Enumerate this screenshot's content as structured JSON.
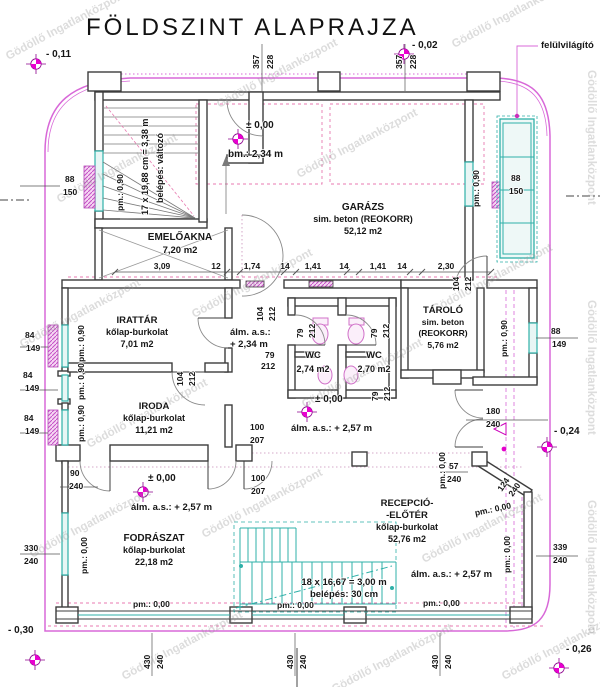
{
  "title": "FÖLDSZINT  ALAPRAJZA",
  "watermark": "Gödöllő Ingatlanközpont",
  "callouts": {
    "skylight": "felülvilágító"
  },
  "levels": {
    "minus011": "- 0,11",
    "minus002": "- 0,02",
    "zero": "± 0,00",
    "minus024": "- 0,24",
    "minus030": "- 0,30",
    "minus026": "- 0,26"
  },
  "heights": {
    "clear_height": "bm.: 2,34 m",
    "ceiling_a": "álm. a.s.:",
    "ceiling_a_val": "+ 2,34 m",
    "ceiling_b": "álm. a.s.: + 2,57 m",
    "parapet_090": "pm.: 0,90",
    "parapet_000": "pm.: 0,00"
  },
  "stairs": {
    "upper_note_1": "17 x 19,88 cm = 3,38 m",
    "upper_note_2": "belépés: változó",
    "lower_note_1": "18 x 16,67 = 3,00 m",
    "lower_note_2": "belépés: 30 cm"
  },
  "rooms": {
    "garazs": {
      "name": "GARÁZS",
      "finish": "sim. beton (REOKORR)",
      "area": "52,12 m2"
    },
    "emeloakna": {
      "name": "EMELŐAKNA",
      "area": "7,20 m2"
    },
    "irattar": {
      "name": "IRATTÁR",
      "finish": "kőlap-burkolat",
      "area": "7,01 m2"
    },
    "iroda": {
      "name": "IRODA",
      "finish": "kőlap-burkolat",
      "area": "11,21 m2"
    },
    "wc_left": {
      "name": "WC",
      "area": "2,74 m2"
    },
    "wc_right": {
      "name": "WC",
      "area": "2,70 m2"
    },
    "tarolo": {
      "name": "TÁROLÓ",
      "finish_1": "sim. beton",
      "finish_2": "(REOKORR)",
      "area": "5,76 m2"
    },
    "fodraszat": {
      "name": "FODRÁSZAT",
      "finish": "kőlap-burkolat",
      "area": "22,18 m2"
    },
    "recepcio": {
      "name_1": "RECEPCIÓ-",
      "name_2": "-ELŐTÉR",
      "finish": "kőlap-burkolat",
      "area": "52,76 m2"
    }
  },
  "dims": {
    "d357": "357",
    "d228": "228",
    "d88": "88",
    "d150": "150",
    "d84": "84",
    "d149": "149",
    "d104": "104",
    "d212": "212",
    "d79": "79",
    "d100": "100",
    "d207": "207",
    "d90": "90",
    "d240": "240",
    "d330": "330",
    "d430": "430",
    "d339": "339",
    "d180": "180",
    "d57": "57",
    "d124": "124",
    "row": [
      "3,09",
      "12",
      "1,74",
      "14",
      "1,41",
      "14",
      "1,41",
      "14",
      "2,30"
    ]
  },
  "colors": {
    "boundary": "#d868d8",
    "marker": "#e400cc",
    "glazing": "#2fb0a8",
    "wall": "#3d3d3d",
    "hatch": "#cf5fd0"
  }
}
